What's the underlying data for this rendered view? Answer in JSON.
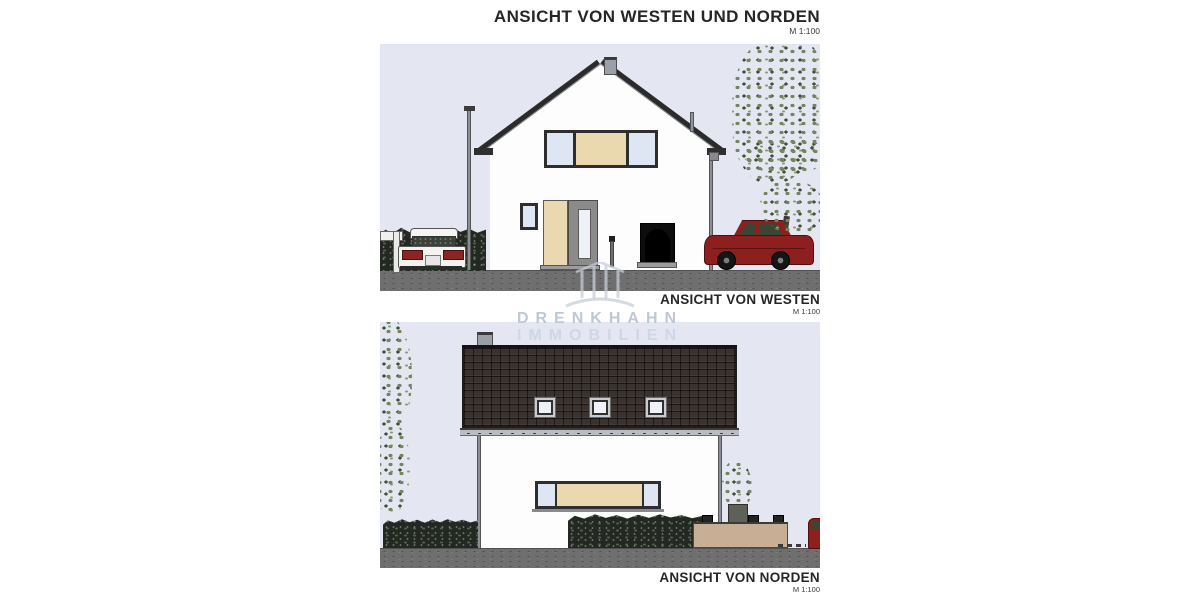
{
  "header": {
    "title": "ANSICHT VON WESTEN UND NORDEN",
    "scale": "M 1:100"
  },
  "west_view": {
    "label": "ANSICHT VON WESTEN",
    "scale": "M 1:100"
  },
  "north_view": {
    "label": "ANSICHT VON NORDEN",
    "scale": "M 1:100"
  },
  "watermark": {
    "line1": "DRENKHAHN",
    "line2": "IMMOBILIEN",
    "logo": "drenkhahn-arch-logo"
  },
  "colors": {
    "sky": "#e4e7f1",
    "ground": "#6f6f6f",
    "wall_white": "#fdfdfd",
    "roof_edge": "#2b2b2b",
    "roof_tile": "#39322e",
    "tan_panel": "#ead8ae",
    "window_frame": "#2e2e2e",
    "glass": "#dde6f2",
    "door_gray": "#8b8b89",
    "cellar_dark": "#0d0d0d",
    "hedge_green": "#232922",
    "foliage_green": "#74855f",
    "red_car": "#8e1f1f",
    "garden_wall_tan": "#c7ae94",
    "watermark_gray": "#c3cbd9"
  }
}
